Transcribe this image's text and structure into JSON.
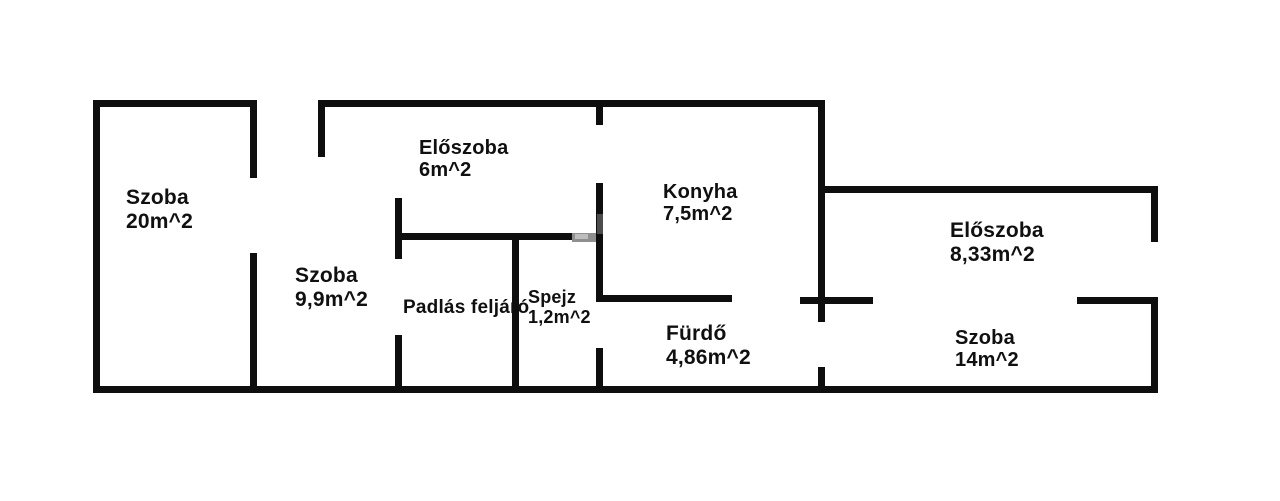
{
  "title": "Apartment floor plan",
  "canvas": {
    "width": 1280,
    "height": 501,
    "background_color": "#ffffff",
    "wall_color": "#0e0e0e",
    "text_color": "#101010"
  },
  "rooms": [
    {
      "id": "szoba-20",
      "name": "Szoba",
      "area": "20m^2",
      "x": 126,
      "y": 186,
      "font_size": 21
    },
    {
      "id": "eloszoba-6",
      "name": "Előszoba",
      "area": "6m^2",
      "x": 419,
      "y": 137,
      "font_size": 20
    },
    {
      "id": "konyha",
      "name": "Konyha",
      "area": "7,5m^2",
      "x": 663,
      "y": 181,
      "font_size": 20
    },
    {
      "id": "eloszoba-8-33",
      "name": "Előszoba",
      "area": "8,33m^2",
      "x": 950,
      "y": 219,
      "font_size": 21
    },
    {
      "id": "szoba-9-9",
      "name": "Szoba",
      "area": "9,9m^2",
      "x": 295,
      "y": 264,
      "font_size": 21
    },
    {
      "id": "padlas-feljaro",
      "name": "Padlás feljáró",
      "area": "",
      "x": 403,
      "y": 297,
      "font_size": 19
    },
    {
      "id": "spejz",
      "name": "Spejz",
      "area": "1,2m^2",
      "x": 528,
      "y": 287,
      "font_size": 18
    },
    {
      "id": "furdo",
      "name": "Fürdő",
      "area": "4,86m^2",
      "x": 666,
      "y": 322,
      "font_size": 21
    },
    {
      "id": "szoba-14",
      "name": "Szoba",
      "area": "14m^2",
      "x": 955,
      "y": 327,
      "font_size": 20
    }
  ],
  "walls": [
    {
      "name": "outer-wall-left",
      "x": 93,
      "y": 100,
      "w": 7,
      "h": 293
    },
    {
      "name": "outer-wall-top-left",
      "x": 93,
      "y": 100,
      "w": 164,
      "h": 7
    },
    {
      "name": "outer-wall-top-main",
      "x": 318,
      "y": 100,
      "w": 507,
      "h": 7
    },
    {
      "name": "outer-wall-bottom",
      "x": 93,
      "y": 386,
      "w": 1065,
      "h": 7
    },
    {
      "name": "mid-vertical-wall-upper",
      "x": 818,
      "y": 100,
      "w": 7,
      "h": 222
    },
    {
      "name": "mid-vertical-wall-lower",
      "x": 818,
      "y": 367,
      "w": 7,
      "h": 26
    },
    {
      "name": "right-section-top-wall",
      "x": 818,
      "y": 186,
      "w": 340,
      "h": 7
    },
    {
      "name": "outer-wall-right-upper",
      "x": 1151,
      "y": 186,
      "w": 7,
      "h": 56
    },
    {
      "name": "outer-wall-right-lower",
      "x": 1151,
      "y": 297,
      "w": 7,
      "h": 96
    },
    {
      "name": "szoba20-divider-upper",
      "x": 250,
      "y": 100,
      "w": 7,
      "h": 78
    },
    {
      "name": "szoba20-divider-lower",
      "x": 250,
      "y": 253,
      "w": 7,
      "h": 140
    },
    {
      "name": "entry-stub-wall",
      "x": 318,
      "y": 100,
      "w": 7,
      "h": 57
    },
    {
      "name": "padlas-divider-upper",
      "x": 395,
      "y": 198,
      "w": 7,
      "h": 61
    },
    {
      "name": "padlas-divider-lower",
      "x": 395,
      "y": 335,
      "w": 7,
      "h": 58
    },
    {
      "name": "eloszoba6-bottom-wall",
      "x": 395,
      "y": 233,
      "w": 205,
      "h": 7
    },
    {
      "name": "spejz-left-wall",
      "x": 512,
      "y": 237,
      "w": 7,
      "h": 156
    },
    {
      "name": "konyha-left-wall-top",
      "x": 596,
      "y": 100,
      "w": 7,
      "h": 25
    },
    {
      "name": "konyha-left-wall-mid",
      "x": 596,
      "y": 183,
      "w": 7,
      "h": 119
    },
    {
      "name": "spejz-right-wall-lower",
      "x": 596,
      "y": 348,
      "w": 7,
      "h": 45
    },
    {
      "name": "konyha-furdo-divider",
      "x": 596,
      "y": 295,
      "w": 136,
      "h": 7
    },
    {
      "name": "furdo-szoba14-divider-stub",
      "x": 800,
      "y": 297,
      "w": 73,
      "h": 7
    },
    {
      "name": "eloszoba833-szoba14-divider",
      "x": 1077,
      "y": 297,
      "w": 81,
      "h": 7
    }
  ],
  "artifacts": [
    {
      "name": "watermark-remnant",
      "x": 572,
      "y": 233,
      "w": 24,
      "h": 9,
      "color": "#8f8f8f"
    },
    {
      "name": "watermark-remnant",
      "x": 575,
      "y": 234,
      "w": 13,
      "h": 5,
      "color": "#bdbdbd"
    },
    {
      "name": "watermark-remnant",
      "x": 597,
      "y": 214,
      "w": 6,
      "h": 20,
      "color": "#4d4d4d"
    }
  ]
}
